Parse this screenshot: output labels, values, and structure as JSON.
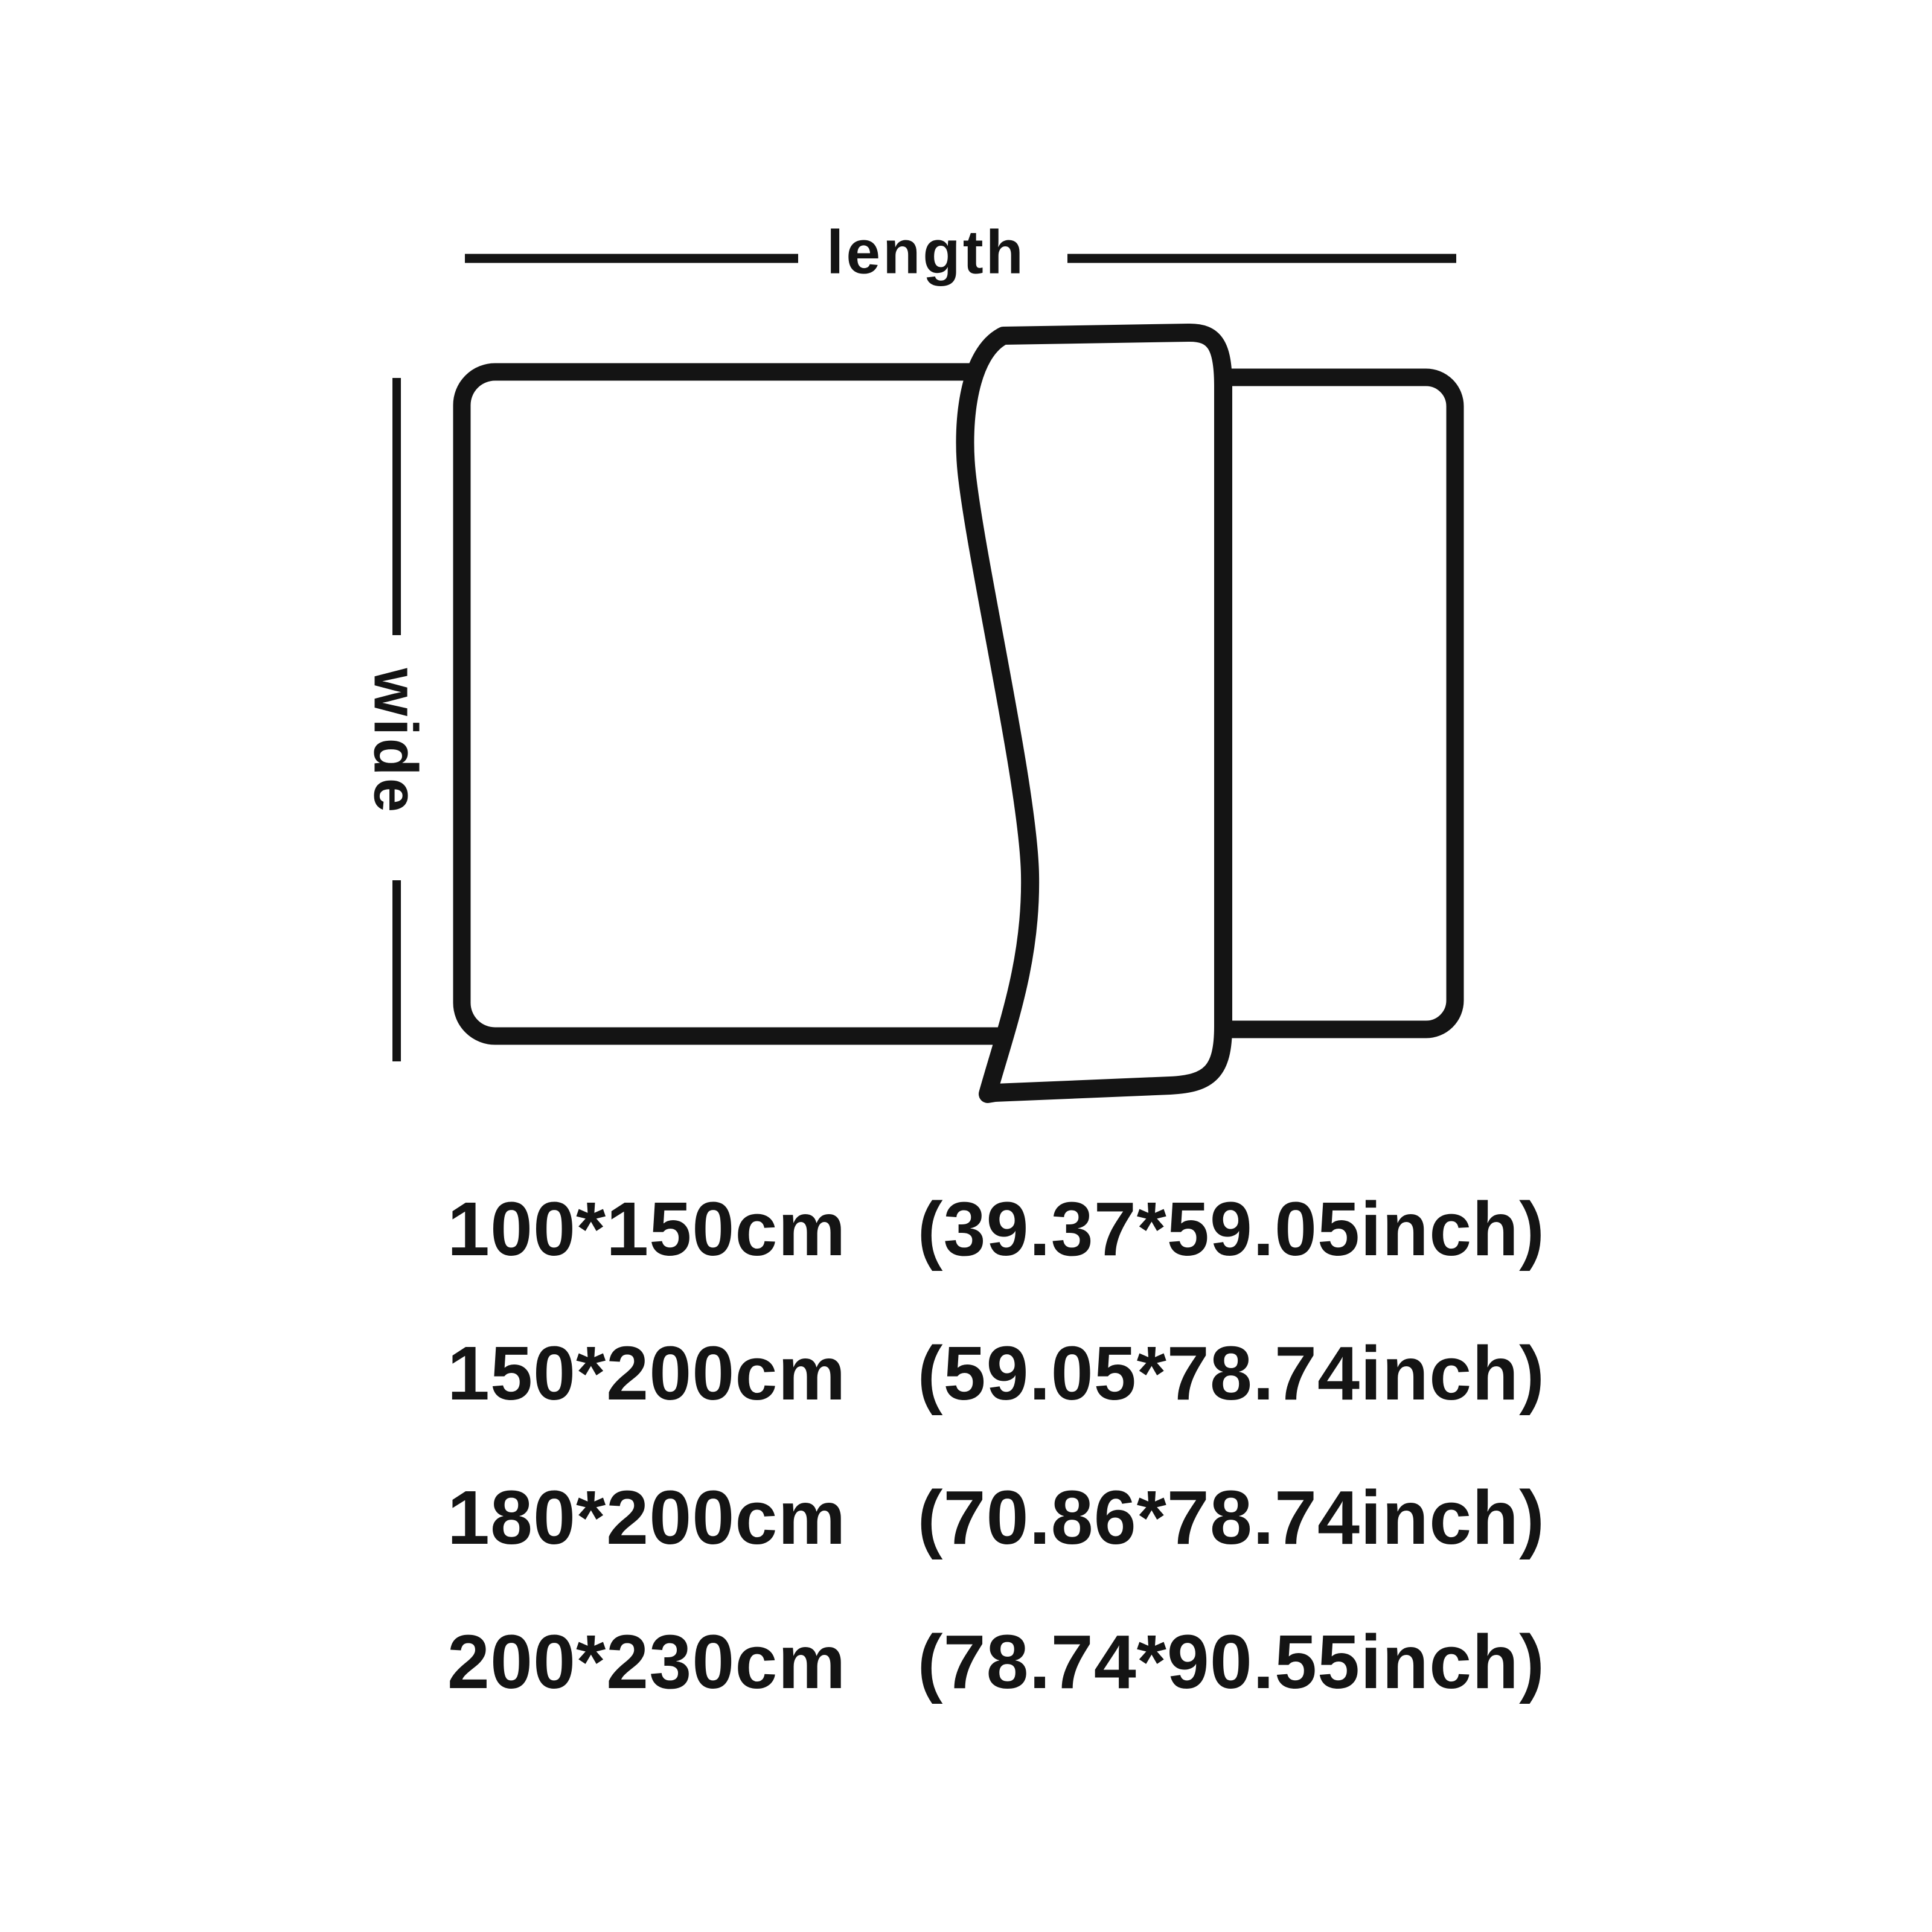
{
  "colors": {
    "ink": "#141414",
    "background": "#ffffff"
  },
  "diagram": {
    "length_label": "length",
    "width_label": "wide"
  },
  "size_list": {
    "rows": [
      {
        "cm": "100*150cm",
        "inch": "(39.37*59.05inch)"
      },
      {
        "cm": "150*200cm",
        "inch": "(59.05*78.74inch)"
      },
      {
        "cm": "180*200cm",
        "inch": "(70.86*78.74inch)"
      },
      {
        "cm": "200*230cm",
        "inch": "(78.74*90.55inch)"
      }
    ]
  }
}
